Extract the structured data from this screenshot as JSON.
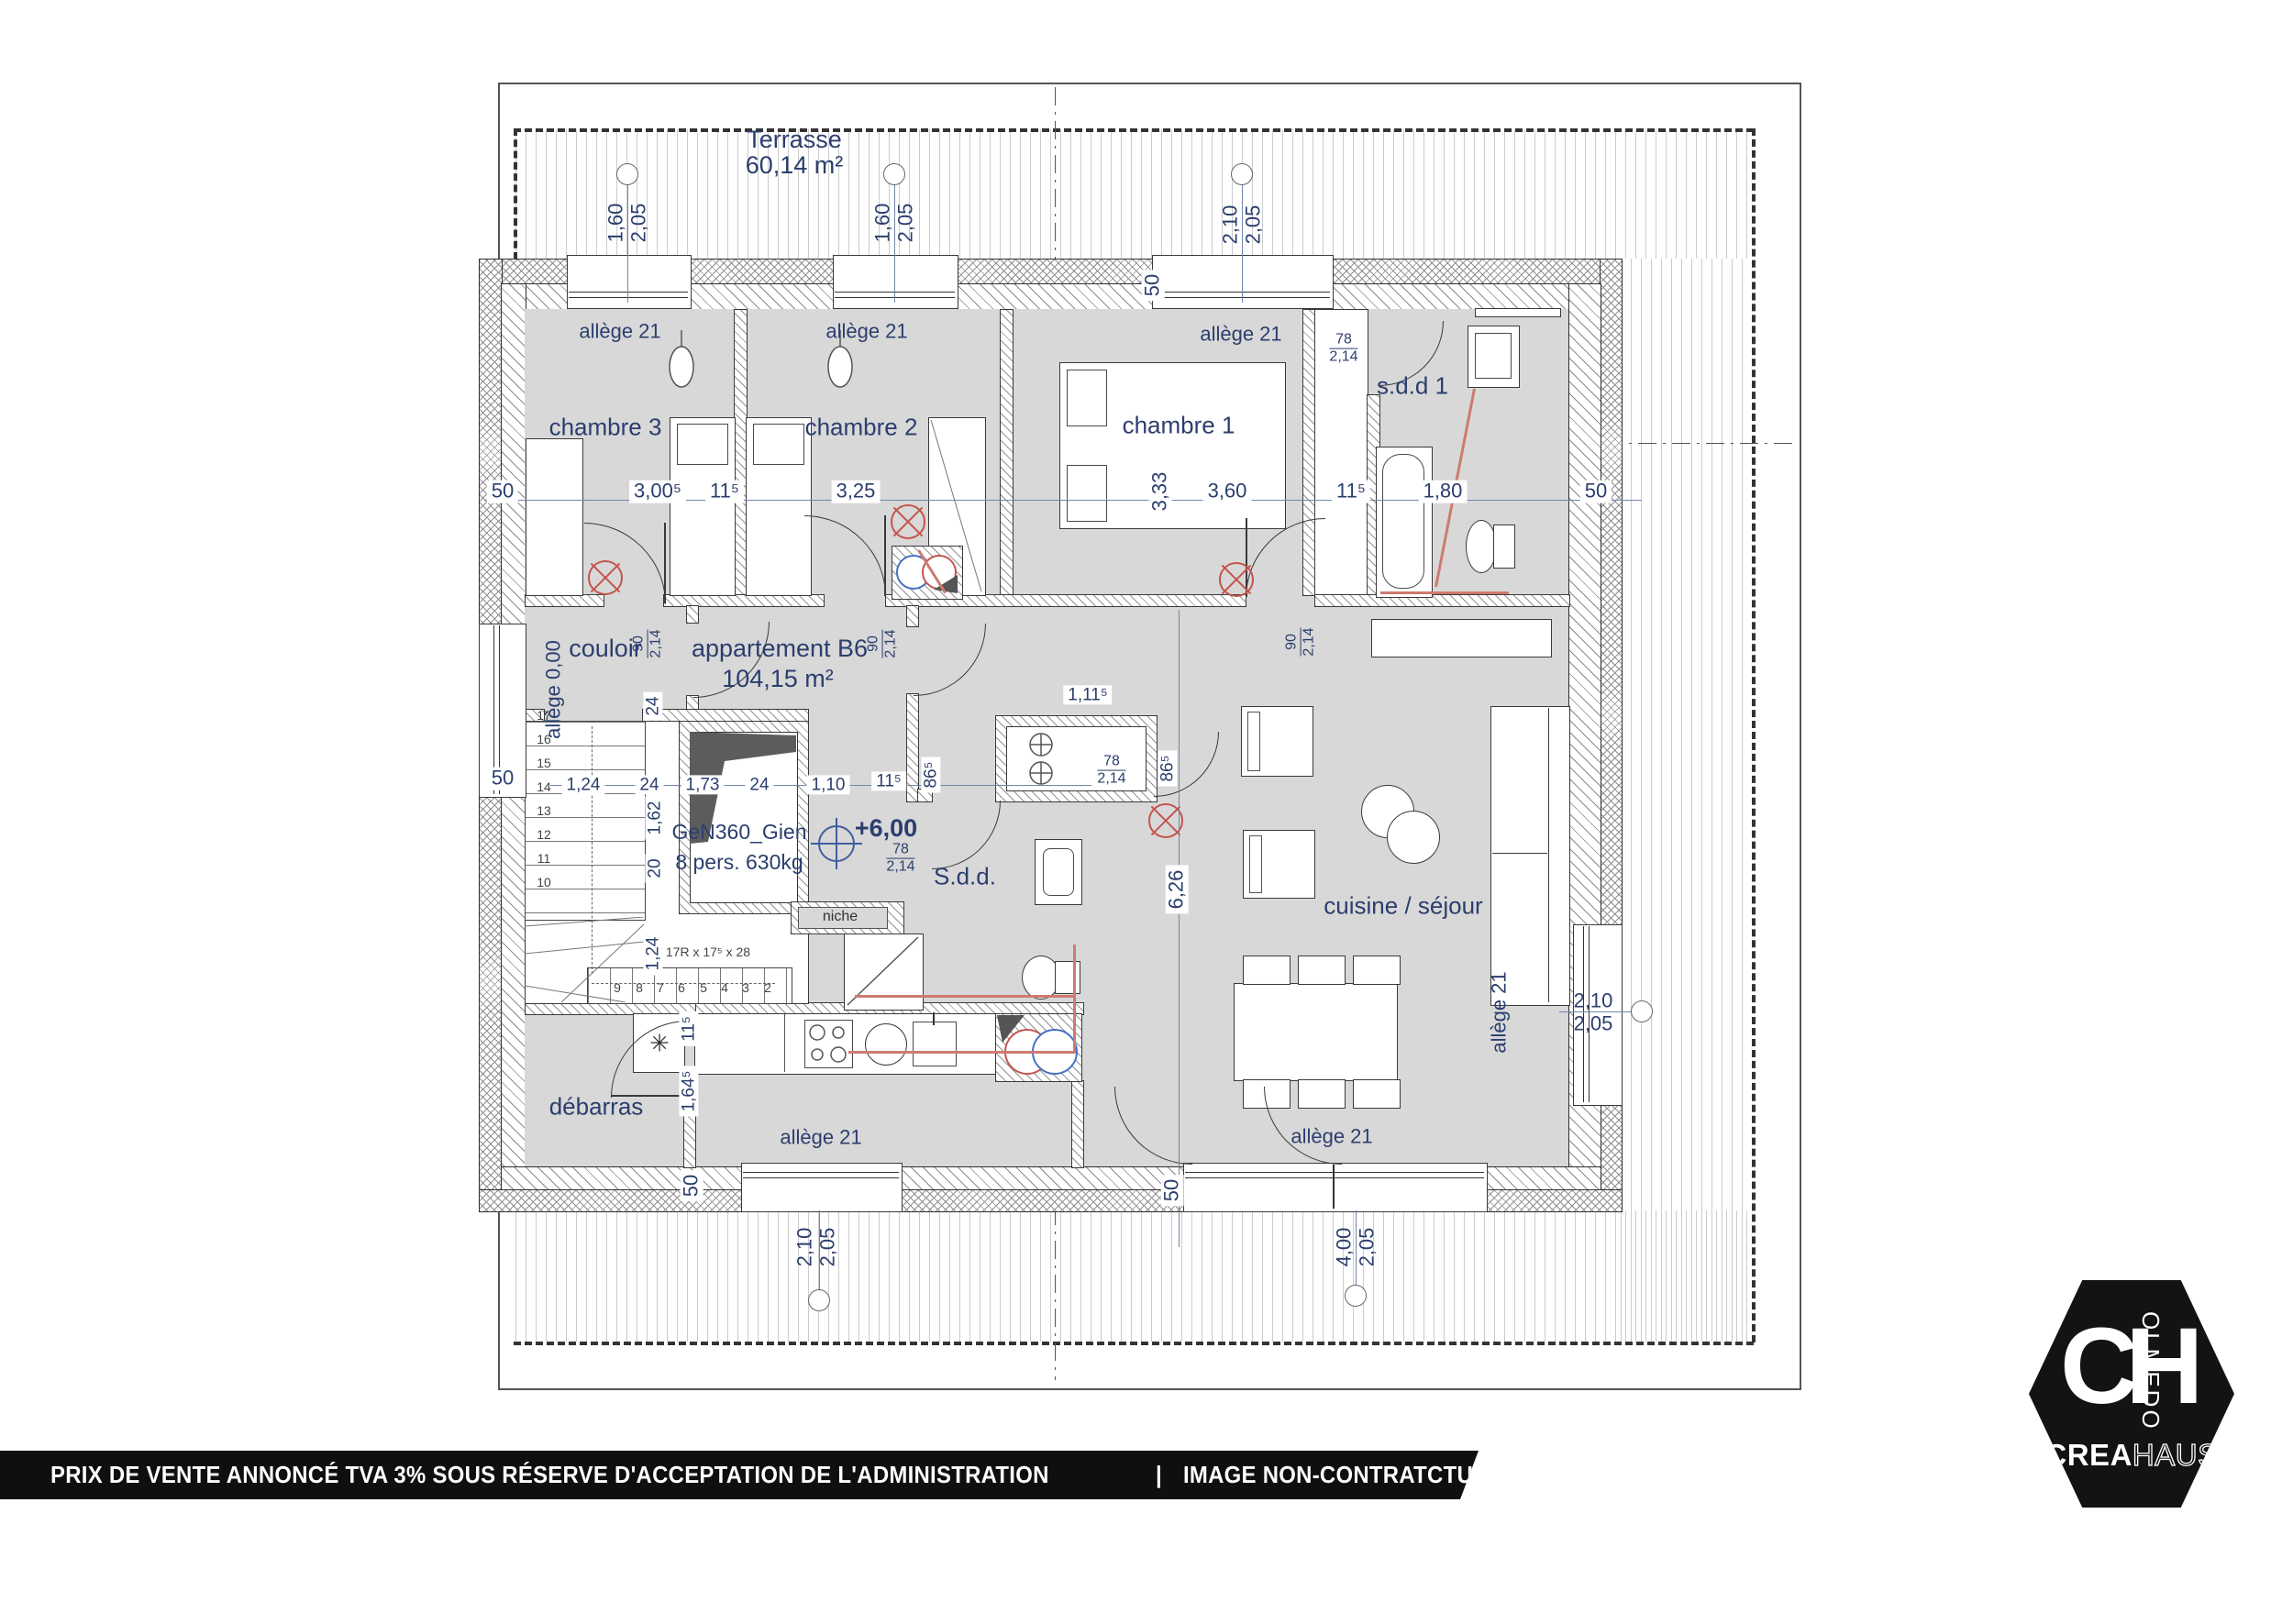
{
  "colors": {
    "navy": "#2b3e6e",
    "accent_red": "#c4554d",
    "gold": "#e0a23c",
    "floor_gray": "#d8d8d8",
    "footer_bg": "#0f0f0f"
  },
  "footer": {
    "main": "PRIX DE VENTE ANNONCÉ TVA 3% SOUS RÉSERVE D'ACCEPTATION DE L'ADMINISTRATION",
    "sep1": "|",
    "secondary": "IMAGE NON-CONTRATCTUELLE",
    "sep2": "|",
    "url": "WWW.CREAHAUS.LU"
  },
  "logo": {
    "monogram": "CH",
    "vertical": "OLMEDO",
    "brand_bold": "CREA",
    "brand_light": "HAUS"
  },
  "plan": {
    "terrace": {
      "title": "Terrasse",
      "area": "60,14 m²"
    },
    "apartment": {
      "title": "appartement B6",
      "area": "104,15 m²"
    },
    "rooms": {
      "ch3": "chambre 3",
      "ch2": "chambre 2",
      "ch1": "chambre 1",
      "sdd1": "s.d.d 1",
      "couloir": "couloir",
      "sdd": "S.d.d.",
      "cuisine": "cuisine / séjour",
      "debarras": "débarras",
      "niche": "niche"
    },
    "lift": {
      "model": "GeN360_Gien",
      "capacity": "8 pers. 630kg",
      "level": "+6,00"
    },
    "stairs": {
      "formula": "17R x 17⁵ x 28",
      "upper": [
        "17",
        "16",
        "15",
        "14",
        "13",
        "12",
        "11",
        "10"
      ],
      "lower": [
        "9",
        "8",
        "7",
        "6",
        "5",
        "4",
        "3",
        "2"
      ]
    },
    "labels": {
      "allege21": "allège 21",
      "allege000": "allège 0,00"
    },
    "windows": {
      "w160": {
        "w": "1,60",
        "h": "2,05"
      },
      "w210": {
        "w": "2,10",
        "h": "2,05"
      },
      "w400": {
        "w": "4,00",
        "h": "2,05"
      }
    },
    "doors": {
      "d90": {
        "w": "90",
        "h": "2,14"
      },
      "d78": {
        "w": "78",
        "h": "2,14"
      }
    },
    "dims": {
      "wall50": "50",
      "p115": "11⁵",
      "c3005": "3,00⁵",
      "c325": "3,25",
      "c333": "3,33",
      "c360": "3,60",
      "c180": "1,80",
      "n24": "24",
      "c124": "1,24",
      "c173": "1,73",
      "c110": "1,10",
      "c162": "1,62",
      "n20": "20",
      "c1115": "1,11⁵",
      "c865": "86⁵",
      "c626": "6,26",
      "c1645": "1,64⁵"
    },
    "icons": {
      "snowflake": "✳"
    }
  }
}
